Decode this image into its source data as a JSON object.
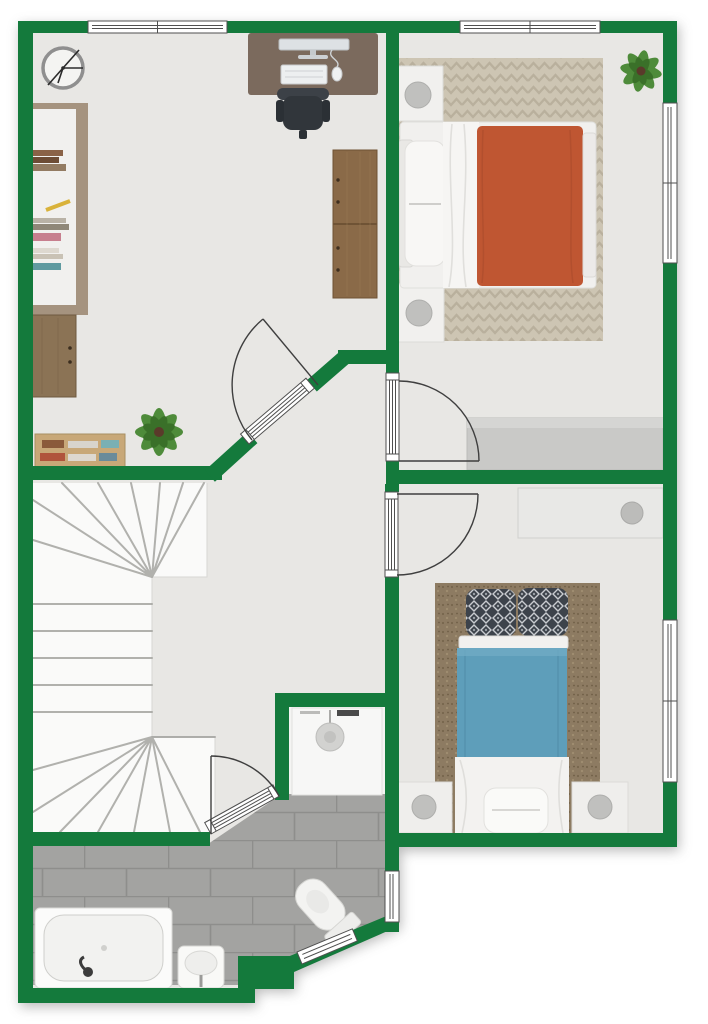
{
  "plan": {
    "title": "residential-upper-floor-plan",
    "style": "top-down 2D render",
    "canvas": {
      "width": 708,
      "height": 1024
    }
  },
  "colors": {
    "wall": "#147a3c",
    "floor": "#e8e7e4",
    "outside": "#ffffff",
    "stairs_bg": "#fafaf9",
    "tile": "#a3a3a1",
    "tile_grout": "#8e8e8c",
    "closet_floor": "#f4f4f2",
    "rug_master": "#cdc5b3",
    "rug_master_pattern": "#b9b09d",
    "rug_kids": "#8d7b62",
    "rug_kids_speckle": "#77664d",
    "blanket_orange": "#bf5632",
    "blanket_blue": "#5e9eba",
    "pillow_dark": "#3d434b",
    "pillow_lattice": "#c9ccd0",
    "wood_desk": "#7b6a5d",
    "wood_wardrobe": "#8a6a48",
    "wood_cabinet": "#8b7355",
    "wood_shelf": "#c8a878",
    "white_furniture": "#f1f0ee",
    "lamp_gray": "#c0c0be",
    "plant_green": "#4e8b3a",
    "plant_green_dark": "#3a7029",
    "chair_dark": "#31363b",
    "fixture_white": "#f9f9f7"
  },
  "rooms": [
    {
      "id": "office",
      "position": "top-left",
      "furniture": [
        "wall-clock",
        "desk",
        "computer-monitor",
        "keyboard",
        "mouse",
        "office-chair",
        "bookcase",
        "sideboard-cabinet",
        "wardrobe",
        "low-bookshelf",
        "potted-plant"
      ]
    },
    {
      "id": "bedroom-master",
      "position": "top-right",
      "furniture": [
        "double-bed-orange-duvet",
        "nightstand-with-lamp",
        "nightstand-with-lamp",
        "chevron-rug",
        "gray-dresser",
        "potted-plant"
      ],
      "windows": 2,
      "doors": 1
    },
    {
      "id": "bedroom-single",
      "position": "bottom-right",
      "furniture": [
        "single-bed-blue-duvet",
        "patterned-pillow",
        "patterned-pillow",
        "shag-rug",
        "white-dresser-with-lamp",
        "nightstand-with-lamp",
        "nightstand-with-lamp",
        "foot-bench"
      ],
      "windows": 1,
      "doors": 1
    },
    {
      "id": "hallway-landing",
      "position": "center",
      "furniture": [
        "winder-staircase"
      ]
    },
    {
      "id": "utility-closet",
      "position": "center-bottom",
      "furniture": [
        "washing-machine"
      ]
    },
    {
      "id": "bathroom",
      "position": "bottom-left",
      "furniture": [
        "bathtub",
        "washbasin",
        "toilet"
      ],
      "windows": 2,
      "doors": 1
    }
  ],
  "openings": {
    "windows_total": 6,
    "interior_doors_total": 4
  }
}
